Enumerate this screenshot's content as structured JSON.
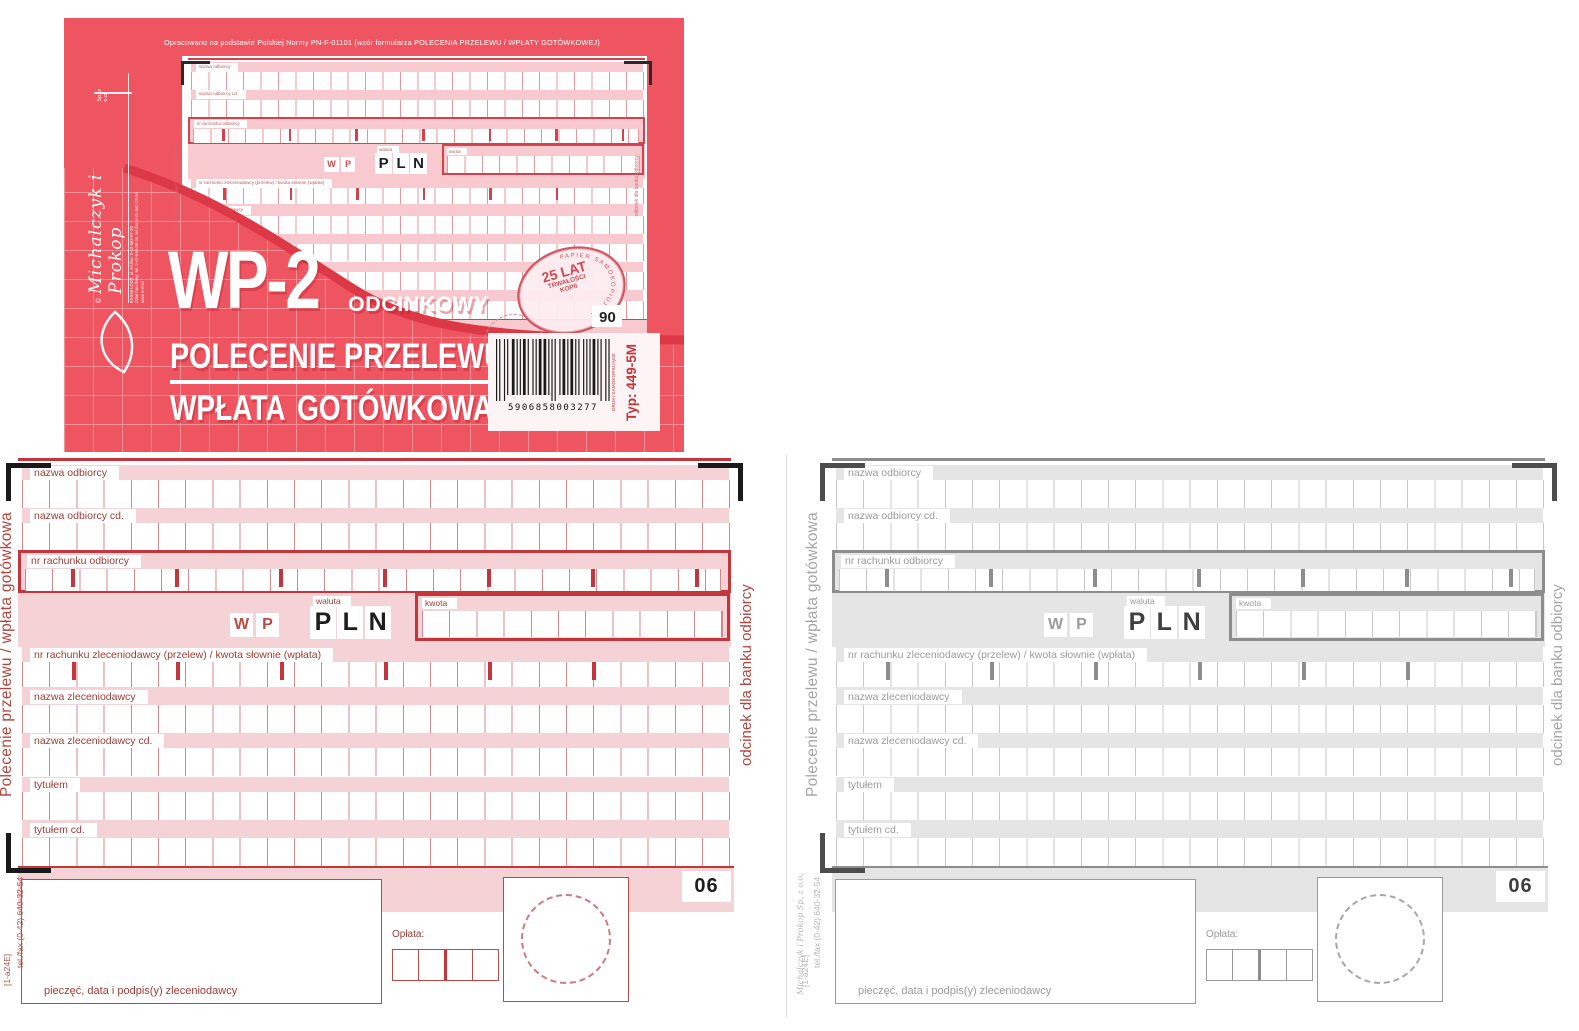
{
  "cover": {
    "norm_line": "Opracowano na podstawie Polskiej Normy PN-F-01101 (wzór formularza POLECENIA PRZELEWU / WPŁATY GOTÓWKOWEJ)",
    "brand": {
      "copyright": "©",
      "name": "Michalczyk i Prokop",
      "suffix": "Sp. z o.o.",
      "address_lines": [
        "93-558 ŁÓDŹ, ul.  tel./fax: 0-42-683-57-28",
        "Dział handlowy: tel. 0-42-640-30-34, tel./fax 0-42-640-32-54",
        "www  e-mail"
      ]
    },
    "title": "WP-2",
    "title_suffix": "ODCINKOWY",
    "subtitle_1": "POLECENIE PRZELEWU",
    "subtitle_2": "WPŁATA GOTÓWKOWA",
    "stamp": {
      "line1": "25 LAT",
      "line2": "TRWAŁOŚCI",
      "line3": "KOPII",
      "ring_text": "PAPIER SAMOKOPIUJĄCY"
    },
    "mini_sheet_no": "06",
    "barcode": {
      "digits": "5906858003277",
      "type_label": "Typ: 449-5M",
      "print_label": "DRUKI SAMOKOPIUJĄCE"
    }
  },
  "form": {
    "fields": [
      "nazwa odbiorcy",
      "nazwa odbiorcy cd.",
      "nr rachunku odbiorcy",
      "waluta",
      "kwota",
      "nr rachunku zleceniodawcy (przelew) / kwota słownie (wpłata)",
      "nazwa zleceniodawcy",
      "nazwa zleceniodawcy cd.",
      "tytułem",
      "tytułem cd."
    ],
    "wp_letters": [
      "W",
      "P"
    ],
    "currency_letters": [
      "P",
      "L",
      "N"
    ],
    "sheet_no": "06",
    "fee_label": "Opłata:",
    "signature_label": "pieczęć, data i podpis(y) zleceniodawcy",
    "side_left": "Polecenie przelewu / wpłata gotówkowa",
    "side_right": "odcinek dla banku odbiorcy"
  },
  "footers": {
    "pink": [
      "tel./fax (0-42) 640-32-54",
      "[1-a24E]"
    ],
    "gray": [
      "Michalczyk i Prokop Sp. z o.o.",
      "tel./fax (0-42) 640-32-54",
      "[1-a24E]"
    ]
  },
  "colors": {
    "cover_red": "#ee5560",
    "cover_band": "#dc3845",
    "pink": {
      "band": "#f5d2d6",
      "grid": "#d4878d",
      "thick": "#c4363c",
      "label": "#9e3b35",
      "accent": "#bb4a44",
      "dark": "#1d1d1d",
      "bracket": "#1a1a1a",
      "circle": "#cd7b80"
    },
    "gray": {
      "band": "#e5e5e5",
      "grid": "#c7c7c7",
      "thick": "#8d8d8d",
      "label": "#9b9b9b",
      "accent": "#9b9b9b",
      "dark": "#3f3f3f",
      "bracket": "#4d4d4d",
      "circle": "#a8a8a8"
    },
    "mini": {
      "band": "#f8c9ce",
      "grid": "#e8959c",
      "thick": "#d5414d",
      "label": "#c25a60",
      "accent": "#cf4a52",
      "dark": "#1d1d1d",
      "bracket": "#2a2a2a",
      "circle": "#d98a90"
    }
  }
}
